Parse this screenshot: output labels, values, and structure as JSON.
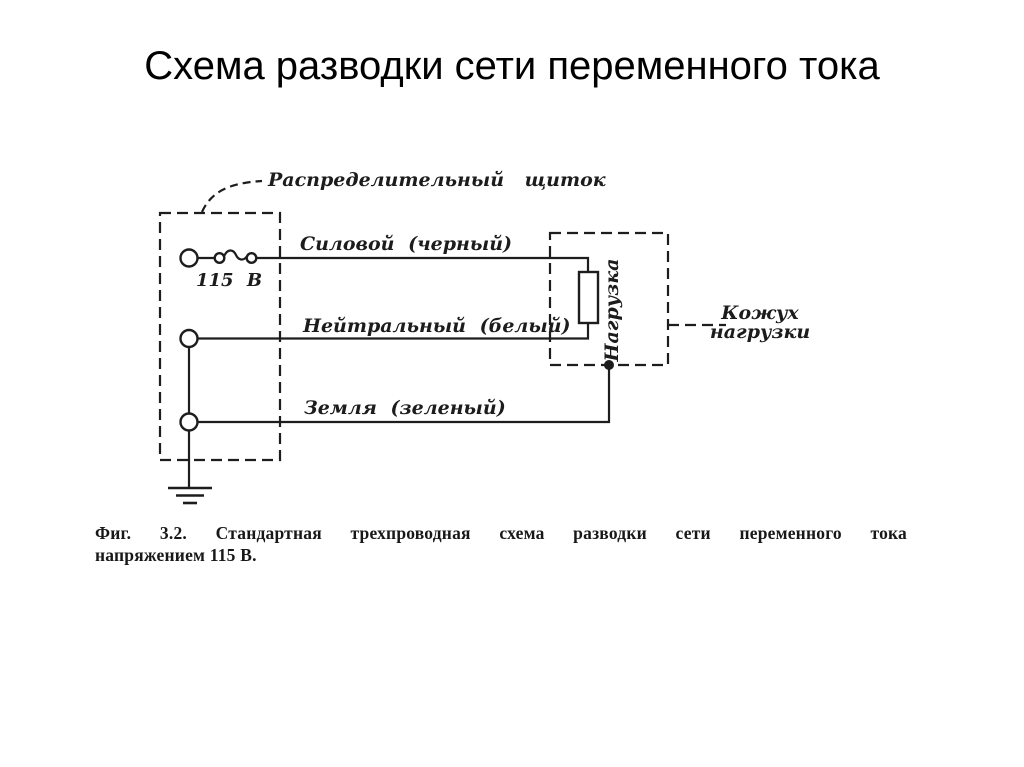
{
  "title": "Схема разводки сети переменного тока",
  "diagram": {
    "panel_label": "Распределительный щиток",
    "voltage_label": "115 В",
    "power_wire_label": "Силовой (черный)",
    "neutral_wire_label": "Нейтральный (белый)",
    "ground_wire_label": "Земля (зеленый)",
    "load_label": "Нагрузка",
    "housing_label_line1": "Кожух",
    "housing_label_line2": "нагрузки"
  },
  "caption": {
    "line1": "Фиг. 3.2. Стандартная трехпроводная схема разводки сети переменного тока",
    "line2": "напряжением 115 В."
  },
  "colors": {
    "ink": "#1d1d1d",
    "background": "#ffffff"
  }
}
